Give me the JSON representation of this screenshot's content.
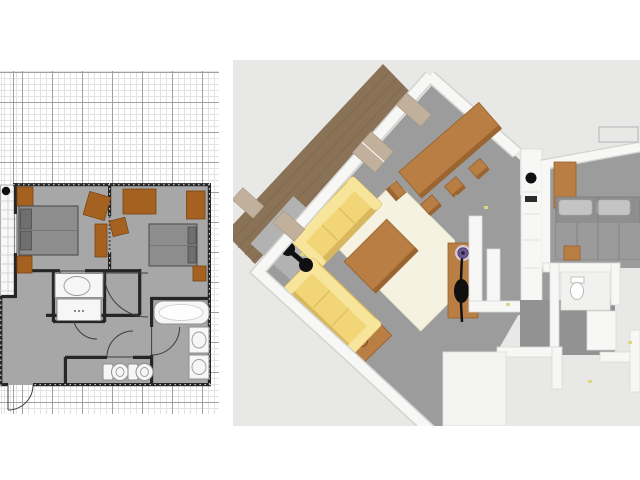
{
  "window": {
    "title": "Home plan viewer",
    "width_px": 640,
    "height_px": 480
  },
  "panels": {
    "plan2d": {
      "name": "2D floor plan with grid",
      "grid": {
        "minor_px": 6,
        "major_px": 30
      }
    },
    "view3d": {
      "name": "3D aerial view of apartment"
    }
  },
  "palette": {
    "page_bg": "#ffffff",
    "grid_bg": "#ffffff",
    "grid_fine": "#e3e3e3",
    "grid_major": "#a0a0a0",
    "plan_floor": "#a7a7a7",
    "plan_wall": "#262626",
    "plan_brown": "#a5611f",
    "plan_bed": "#8d8d8d",
    "plan_bed_border": "#4f4f4f",
    "plan_pillow": "#6f6f6f",
    "plan_fixture": "#f6f6f6",
    "tile_line": "#c9c9c9",
    "view3d_bg": "#e8e8e6",
    "floor_gray": "#9c9c9c",
    "floor_light": "#b2b2b2",
    "deck_brown": "#8a7257",
    "deck_line": "#7a644b",
    "wall_white": "#f7f7f6",
    "wall_shade": "#d2d2d0",
    "sofa_yellow": "#f1d577",
    "sofa_back": "#f7e59c",
    "sofa_shadow": "#d9b75f",
    "rug_cream": "#f6f2e1",
    "wood_brown": "#b97e43",
    "wood_dark": "#9a6530",
    "bed_gray": "#8f8f8f",
    "bed_sheet": "#9b9b9b",
    "bed_pillow": "#c4c4c4",
    "window_tan": "#c1b09b",
    "black": "#101010",
    "purple": "#6d5694",
    "switch_yellow": "#ddd487"
  },
  "plan2d_objects": {
    "rooms": [
      "terrace",
      "bedroom-left",
      "bedroom-right",
      "bathroom",
      "hallway",
      "wc",
      "bath-room"
    ],
    "furniture": [
      "double-bed-left",
      "double-bed-right",
      "desk-left",
      "desk-right",
      "wardrobe",
      "chair-square",
      "side-shelf",
      "bed-mat-top",
      "bed-mat-bottom",
      "nightstand",
      "sink",
      "shower",
      "bathtub",
      "washbasin-1",
      "washbasin-2",
      "toilet-1",
      "toilet-2"
    ],
    "door_count": 6
  },
  "view3d_objects": {
    "furniture": [
      "deck",
      "sofa-top",
      "sofa-left",
      "area-rug",
      "coffee-table",
      "side-table",
      "floor-lamp",
      "dining-table",
      "dining-chairs",
      "window-panes",
      "kitchen-counter",
      "cooktop",
      "hall-wood-floor",
      "coat-stand",
      "double-bed",
      "wardrobe",
      "nightstand",
      "toilet",
      "bathroom-walls"
    ]
  }
}
